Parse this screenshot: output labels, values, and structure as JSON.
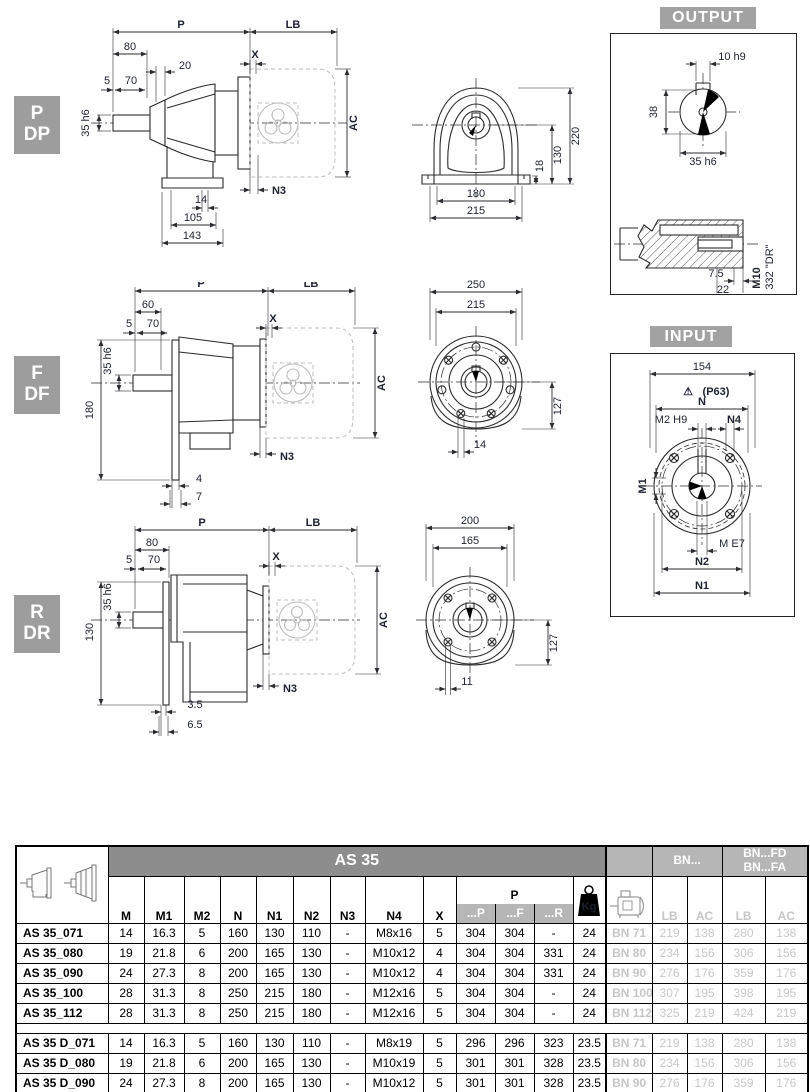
{
  "page": {
    "output_label": "OUTPUT",
    "input_label": "INPUT"
  },
  "tags": {
    "pdp": [
      "P",
      "DP"
    ],
    "fdf": [
      "F",
      "DF"
    ],
    "rdr": [
      "R",
      "DR"
    ]
  },
  "pdp": {
    "side": {
      "p": "P",
      "lb": "LB",
      "d80": "80",
      "d20": "20",
      "x": "X",
      "d5": "5",
      "d70": "70",
      "shaft": "35 h6",
      "ac": "AC",
      "n3": "N3",
      "d14": "14",
      "d105": "105",
      "d143": "143"
    },
    "front": {
      "d220": "220",
      "d130": "130",
      "d18": "18",
      "d180": "180",
      "d215": "215"
    }
  },
  "fdf": {
    "side": {
      "p": "P",
      "lb": "LB",
      "d60": "60",
      "x": "X",
      "d5": "5",
      "d70": "70",
      "shaft": "35 h6",
      "d180": "180",
      "ac": "AC",
      "n3": "N3",
      "d4": "4",
      "d7": "7"
    },
    "front": {
      "d250": "250",
      "d215": "215",
      "d127": "127",
      "d14": "14"
    }
  },
  "rdr": {
    "side": {
      "p": "P",
      "lb": "LB",
      "d80": "80",
      "x": "X",
      "d5": "5",
      "d70": "70",
      "shaft": "35 h6",
      "d130": "130",
      "ac": "AC",
      "n3": "N3",
      "d35": "3.5",
      "d65": "6.5"
    },
    "front": {
      "d200": "200",
      "d165": "165",
      "d127": "127",
      "d11": "11"
    }
  },
  "output_detail": {
    "d10": "10 h9",
    "d38": "38",
    "d35": "35 h6",
    "d75": "7.5",
    "d22": "22",
    "m10": "M10",
    "din": "DIN 332 \"DR\""
  },
  "input_detail": {
    "d154": "154",
    "warn": "⚠",
    "p63": "(P63)",
    "n": "N",
    "m2": "M2 H9",
    "n4": "N4",
    "m1": "M1",
    "me7": "M E7",
    "n2": "N2",
    "n1": "N1"
  },
  "table": {
    "title": "AS 35",
    "dim_cols": [
      "M",
      "M1",
      "M2",
      "N",
      "N1",
      "N2",
      "N3",
      "N4",
      "X"
    ],
    "p_group": {
      "label": "P",
      "subs": [
        "...P",
        "...F",
        "...R"
      ]
    },
    "kg_label": "Kg",
    "bn_header": "BN...",
    "bnfd_line1": "BN...FD",
    "bnfd_line2": "BN...FA",
    "lb_label": "LB",
    "ac_label": "AC",
    "rows_a": [
      {
        "model": "AS 35_071",
        "v": [
          "14",
          "16.3",
          "5",
          "160",
          "130",
          "110",
          "-",
          "M8x16",
          "5",
          "304",
          "304",
          "-",
          "24"
        ],
        "bn": [
          "BN 71",
          "219",
          "138",
          "280",
          "138"
        ]
      },
      {
        "model": "AS 35_080",
        "v": [
          "19",
          "21.8",
          "6",
          "200",
          "165",
          "130",
          "-",
          "M10x12",
          "4",
          "304",
          "304",
          "331",
          "24"
        ],
        "bn": [
          "BN 80",
          "234",
          "156",
          "306",
          "156"
        ]
      },
      {
        "model": "AS 35_090",
        "v": [
          "24",
          "27.3",
          "8",
          "200",
          "165",
          "130",
          "-",
          "M10x12",
          "4",
          "304",
          "304",
          "331",
          "24"
        ],
        "bn": [
          "BN 90",
          "276",
          "176",
          "359",
          "176"
        ]
      },
      {
        "model": "AS 35_100",
        "v": [
          "28",
          "31.3",
          "8",
          "250",
          "215",
          "180",
          "-",
          "M12x16",
          "5",
          "304",
          "304",
          "-",
          "24"
        ],
        "bn": [
          "BN 100",
          "307",
          "195",
          "398",
          "195"
        ]
      },
      {
        "model": "AS 35_112",
        "v": [
          "28",
          "31.3",
          "8",
          "250",
          "215",
          "180",
          "-",
          "M12x16",
          "5",
          "304",
          "304",
          "-",
          "24"
        ],
        "bn": [
          "BN 112",
          "325",
          "219",
          "424",
          "219"
        ]
      }
    ],
    "rows_b": [
      {
        "model": "AS 35 D_071",
        "v": [
          "14",
          "16.3",
          "5",
          "160",
          "130",
          "110",
          "-",
          "M8x19",
          "5",
          "296",
          "296",
          "323",
          "23.5"
        ],
        "bn": [
          "BN 71",
          "219",
          "138",
          "280",
          "138"
        ]
      },
      {
        "model": "AS 35 D_080",
        "v": [
          "19",
          "21.8",
          "6",
          "200",
          "165",
          "130",
          "-",
          "M10x19",
          "5",
          "301",
          "301",
          "328",
          "23.5"
        ],
        "bn": [
          "BN 80",
          "234",
          "156",
          "306",
          "156"
        ]
      },
      {
        "model": "AS 35 D_090",
        "v": [
          "24",
          "27.3",
          "8",
          "200",
          "165",
          "130",
          "-",
          "M10x12",
          "5",
          "301",
          "301",
          "328",
          "23.5"
        ],
        "bn": [
          "BN 90",
          "276",
          "176",
          "359",
          "176"
        ]
      }
    ]
  }
}
